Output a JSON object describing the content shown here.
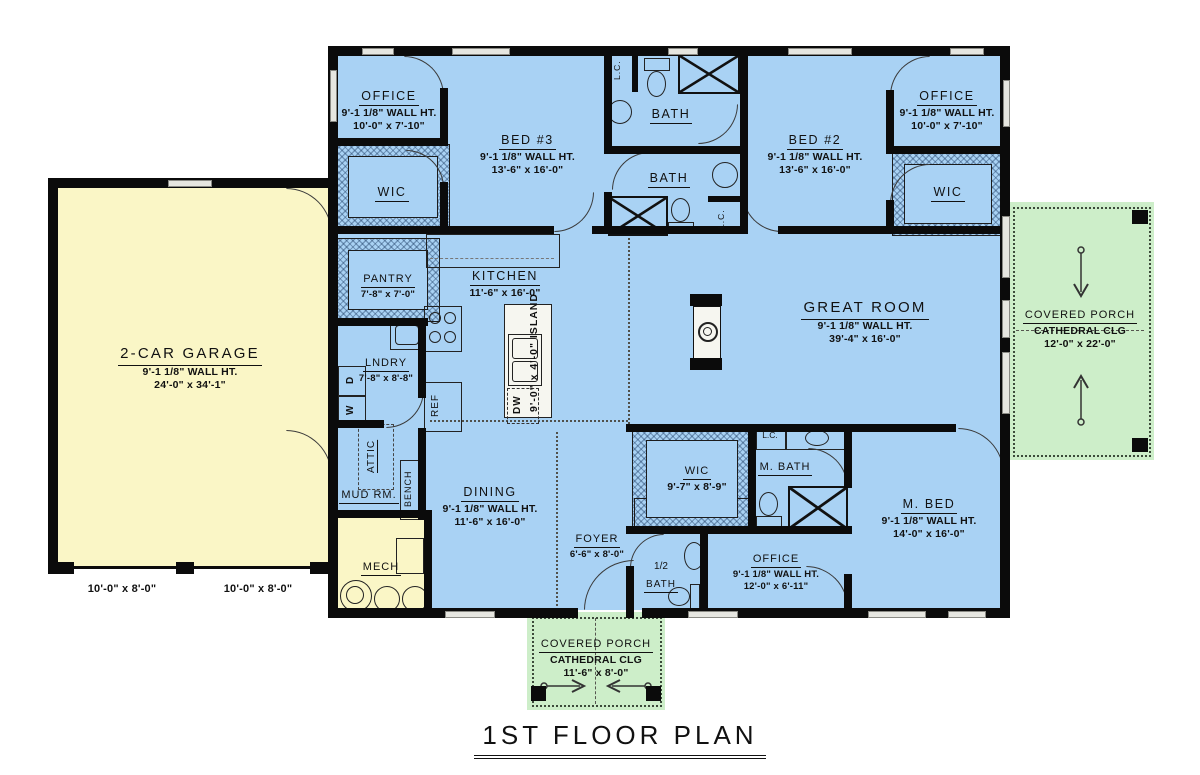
{
  "title": "1ST FLOOR PLAN",
  "colors": {
    "floor_blue": "#a9d2f4",
    "garage_yellow": "#faf6c6",
    "porch_green": "#cdeec9",
    "wall_black": "#0b0b0b"
  },
  "rooms": {
    "garage": {
      "name": "2-CAR GARAGE",
      "wall_ht": "9'-1 1/8\" WALL HT.",
      "dims": "24'-0\" x 34'-1\""
    },
    "office_top_left": {
      "name": "OFFICE",
      "wall_ht": "9'-1 1/8\" WALL HT.",
      "dims": "10'-0\" x 7'-10\""
    },
    "wic_left": {
      "name": "WIC"
    },
    "bed3": {
      "name": "BED #3",
      "wall_ht": "9'-1 1/8\" WALL HT.",
      "dims": "13'-6\" x 16'-0\""
    },
    "bath_upper": {
      "name": "BATH"
    },
    "bath_lower": {
      "name": "BATH"
    },
    "bed2": {
      "name": "BED #2",
      "wall_ht": "9'-1 1/8\" WALL HT.",
      "dims": "13'-6\" x 16'-0\""
    },
    "office_top_right": {
      "name": "OFFICE",
      "wall_ht": "9'-1 1/8\" WALL HT.",
      "dims": "10'-0\" x 7'-10\""
    },
    "wic_right": {
      "name": "WIC"
    },
    "pantry": {
      "name": "PANTRY",
      "dims": "7'-8\" x 7'-0\""
    },
    "kitchen": {
      "name": "KITCHEN",
      "dims": "11'-6\" x 16'-0\""
    },
    "laundry": {
      "name": "LNDRY",
      "dims": "7'-8\" x 8'-8\""
    },
    "great_room": {
      "name": "GREAT ROOM",
      "wall_ht": "9'-1 1/8\" WALL HT.",
      "dims": "39'-4\" x 16'-0\""
    },
    "dining": {
      "name": "DINING",
      "wall_ht": "9'-1 1/8\" WALL HT.",
      "dims": "11'-6\" x 16'-0\""
    },
    "master_wic": {
      "name": "WIC",
      "dims": "9'-7\" x 8'-9\""
    },
    "master_bath": {
      "name": "M. BATH"
    },
    "master_bed": {
      "name": "M. BED",
      "wall_ht": "9'-1 1/8\" WALL HT.",
      "dims": "14'-0\" x 16'-0\""
    },
    "foyer": {
      "name": "FOYER",
      "dims": "6'-6\" x 8'-0\""
    },
    "half_bath": {
      "line1": "1/2",
      "line2": "BATH"
    },
    "office_bottom": {
      "name": "OFFICE",
      "wall_ht": "9'-1 1/8\" WALL HT.",
      "dims": "12'-0\" x 6'-11\""
    },
    "mud_room": {
      "name": "MUD RM."
    },
    "mech": {
      "name": "MECH"
    },
    "porch_right": {
      "name": "COVERED PORCH",
      "ceiling": "CATHEDRAL CLG",
      "dims": "12'-0\" x 22'-0\""
    },
    "porch_bottom": {
      "name": "COVERED PORCH",
      "ceiling": "CATHEDRAL CLG",
      "dims": "11'-6\" x 8'-0\""
    }
  },
  "fixtures": {
    "ref": "REF",
    "dw": "DW",
    "washer": "W",
    "dryer": "D",
    "linen_closet": "L.C.",
    "attic": "ATTIC",
    "bench": "BENCH",
    "island": "9'-0\" x 4'-0\" ISLAND"
  },
  "garage_doors": {
    "left": "10'-0\" x 8'-0\"",
    "right": "10'-0\" x 8'-0\""
  }
}
